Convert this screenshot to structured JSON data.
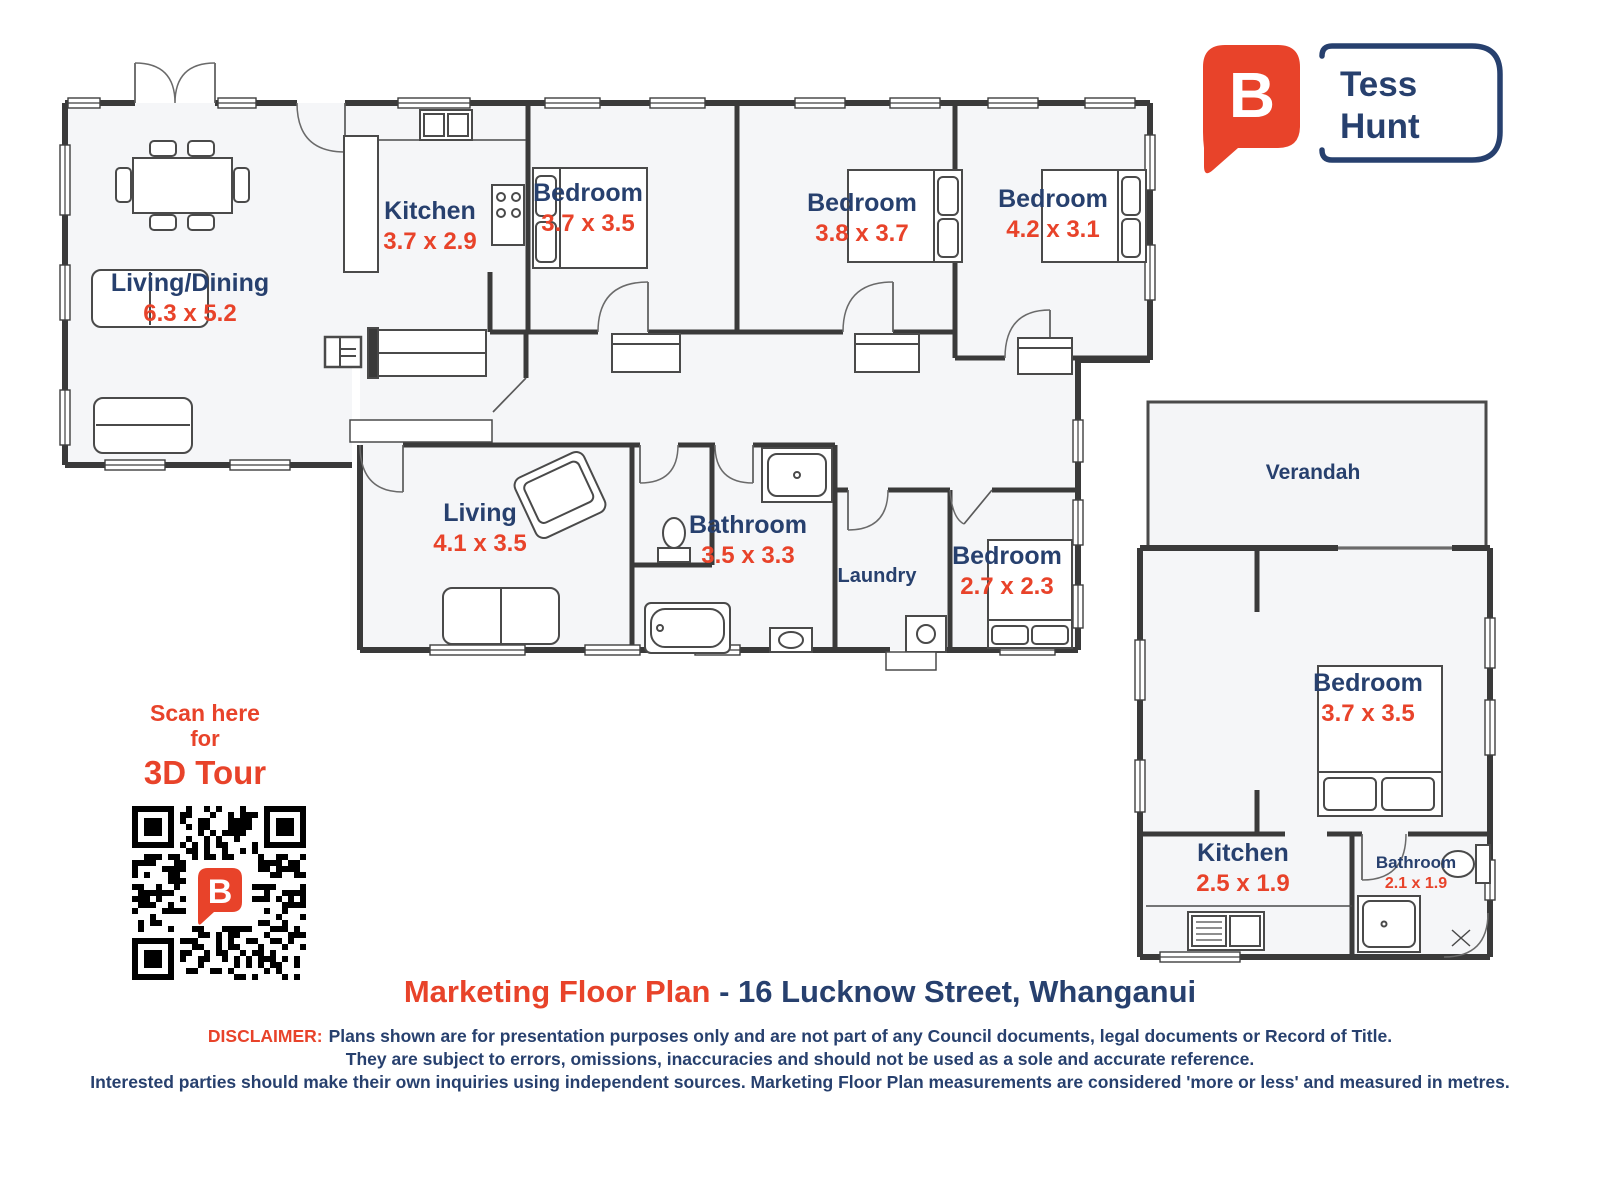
{
  "brand": {
    "logo_letter": "B",
    "agent_first": "Tess",
    "agent_last": "Hunt",
    "colors": {
      "orange": "#e8432a",
      "navy": "#27406e"
    }
  },
  "qr": {
    "line1": "Scan here",
    "line2": "for",
    "line3": "3D Tour",
    "logo_letter": "B"
  },
  "title": {
    "highlight": "Marketing Floor Plan",
    "address": "- 16 Lucknow Street, Whanganui"
  },
  "disclaimer": {
    "label": "DISCLAIMER:",
    "line1": "Plans shown are for presentation purposes only and are not part of any Council documents, legal documents or Record of Title.",
    "line2": "They are subject to errors, omissions, inaccuracies and should not be used as a sole and accurate reference.",
    "line3": "Interested parties should make their own inquiries using independent sources. Marketing Floor Plan measurements are considered 'more or less' and measured in metres."
  },
  "rooms": [
    {
      "name": "Living/Dining",
      "dims": "6.3 x 5.2"
    },
    {
      "name": "Kitchen",
      "dims": "3.7 x 2.9"
    },
    {
      "name": "Bedroom",
      "dims": "3.7 x 3.5"
    },
    {
      "name": "Bedroom",
      "dims": "3.8 x 3.7"
    },
    {
      "name": "Bedroom",
      "dims": "4.2 x 3.1"
    },
    {
      "name": "Living",
      "dims": "4.1 x 3.5"
    },
    {
      "name": "Bathroom",
      "dims": "3.5 x 3.3"
    },
    {
      "name": "Laundry",
      "dims": ""
    },
    {
      "name": "Bedroom",
      "dims": "2.7 x 2.3"
    },
    {
      "name": "Verandah",
      "dims": ""
    },
    {
      "name": "Bedroom",
      "dims": "3.7 x 3.5"
    },
    {
      "name": "Kitchen",
      "dims": "2.5 x 1.9"
    },
    {
      "name": "Bathroom",
      "dims": "2.1 x 1.9"
    }
  ]
}
